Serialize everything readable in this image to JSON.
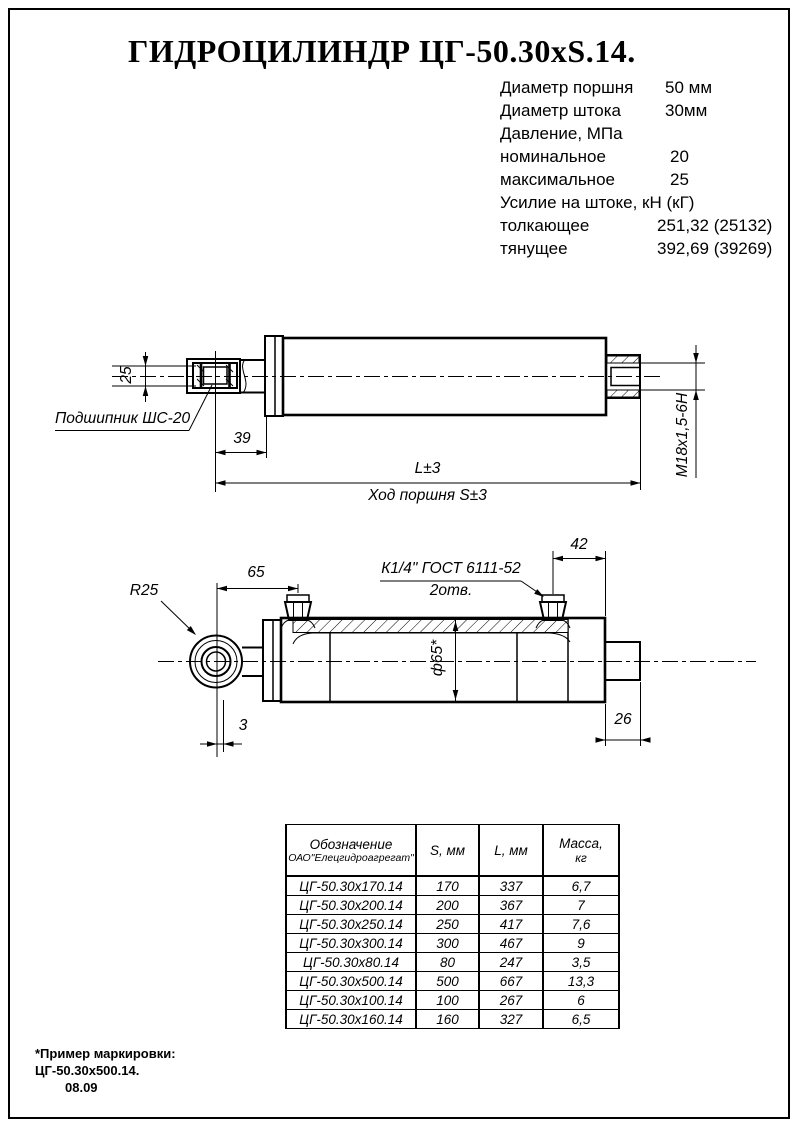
{
  "title": "ГИДРОЦИЛИНДР ЦГ-50.30хS.14.",
  "colors": {
    "ink": "#000000",
    "paper": "#ffffff"
  },
  "specs": {
    "rows": [
      {
        "label": "Диаметр поршня",
        "value": "50 мм"
      },
      {
        "label": "Диаметр штока",
        "value": "30мм"
      },
      {
        "label": "Давление, МПа",
        "value": ""
      },
      {
        "label": "номинальное",
        "value": "20"
      },
      {
        "label": "максимальное",
        "value": "25"
      },
      {
        "label": "Усилие на штоке, кН (кГ)",
        "value": ""
      },
      {
        "label": "толкающее",
        "value": "251,32 (25132)"
      },
      {
        "label": "тянущее",
        "value": "392,69 (39269)"
      }
    ]
  },
  "view1": {
    "dim_bearing_width": "25",
    "bearing_label": "Подшипник ШС-20",
    "dim_rod_end": "39",
    "dim_length": "L±3",
    "stroke_note": "Ход поршня S±3",
    "thread_label": "М18х1,5-6Н"
  },
  "view2": {
    "radius_label": "R25",
    "dim_port_offset": "65",
    "port_spec": "К1/4\" ГОСТ 6111-52",
    "port_count": "2отв.",
    "dim_port_end": "42",
    "bore_label": "ф65*",
    "dim_eye_offset": "3",
    "dim_boss": "26"
  },
  "table": {
    "header": {
      "designation1": "Обозначение",
      "designation2": "ОАО\"Елецгидроагрегат\"",
      "s": "S, мм",
      "l": "L, мм",
      "mass1": "Масса,",
      "mass2": "кг"
    },
    "rows": [
      {
        "designation": "ЦГ-50.30х170.14",
        "s": "170",
        "l": "337",
        "mass": "6,7"
      },
      {
        "designation": "ЦГ-50.30х200.14",
        "s": "200",
        "l": "367",
        "mass": "7"
      },
      {
        "designation": "ЦГ-50.30х250.14",
        "s": "250",
        "l": "417",
        "mass": "7,6"
      },
      {
        "designation": "ЦГ-50.30х300.14",
        "s": "300",
        "l": "467",
        "mass": "9"
      },
      {
        "designation": "ЦГ-50.30х80.14",
        "s": "80",
        "l": "247",
        "mass": "3,5"
      },
      {
        "designation": "ЦГ-50.30х500.14",
        "s": "500",
        "l": "667",
        "mass": "13,3"
      },
      {
        "designation": "ЦГ-50.30х100.14",
        "s": "100",
        "l": "267",
        "mass": "6"
      },
      {
        "designation": "ЦГ-50.30х160.14",
        "s": "160",
        "l": "327",
        "mass": "6,5"
      }
    ]
  },
  "footnote": {
    "line1": "*Пример маркировки:",
    "line2": "ЦГ-50.30х500.14.",
    "line3": "08.09"
  }
}
